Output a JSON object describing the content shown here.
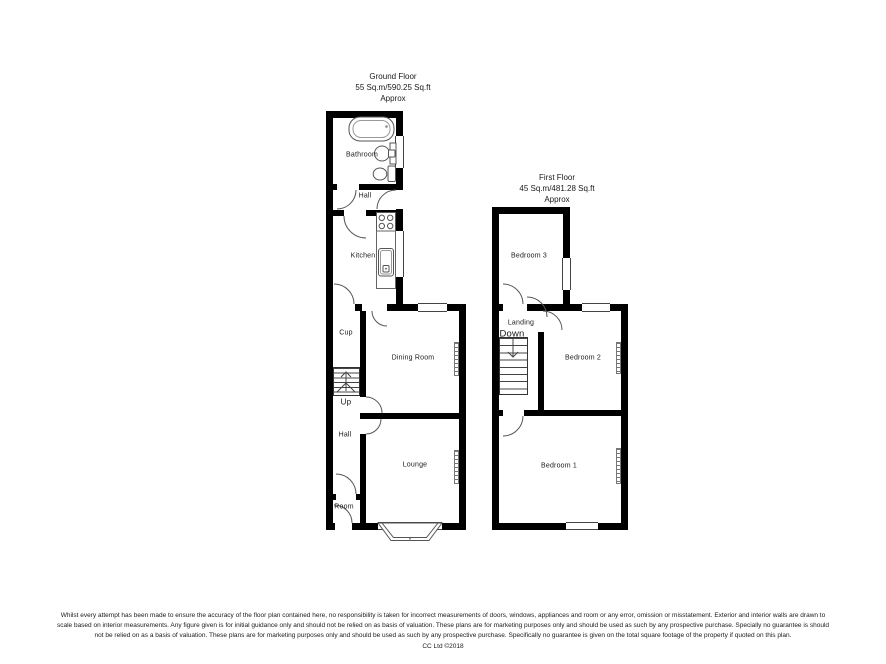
{
  "ground_floor": {
    "title": "Ground Floor",
    "area": "55 Sq.m/590.25 Sq.ft",
    "approx": "Approx",
    "labels": {
      "bathroom": "Bathroom",
      "hall_upper": "Hall",
      "kitchen": "Kitchen",
      "cup": "Cup",
      "dining_room": "Dining Room",
      "up": "Up",
      "hall_lower": "Hall",
      "lounge": "Lounge",
      "room": "Room"
    }
  },
  "first_floor": {
    "title": "First Floor",
    "area": "45 Sq.m/481.28 Sq.ft",
    "approx": "Approx",
    "labels": {
      "bedroom3": "Bedroom 3",
      "landing": "Landing",
      "down": "Down",
      "bedroom2": "Bedroom 2",
      "bedroom1": "Bedroom 1"
    }
  },
  "footer": {
    "disclaimer_line1": "Whilst every attempt has been made to ensure the accuracy of the floor plan contained here, no responsibility is taken for incorrect measurements of doors, windows, appliances and room or any error, omission or misstatement. Exterior and interior walls are drawn to",
    "disclaimer_line2": "scale based on interior measurements. Any figure given is for initial guidance only and should not be relied on as basis of valuation. These plans are for marketing purposes only and should be used as such by any prospective purchase. Specially no guarantee is should",
    "disclaimer_line3": "not be relied on as a basis of valuation. These plans are for marketing purposes only and should be used as such by any prospective purchase. Specifically no guarantee is given on the total square footage of the property if quoted on this plan.",
    "copyright": "CC Ltd ©2018"
  },
  "colors": {
    "wall": "#000000",
    "background": "#ffffff",
    "fixture_line": "#555555"
  }
}
